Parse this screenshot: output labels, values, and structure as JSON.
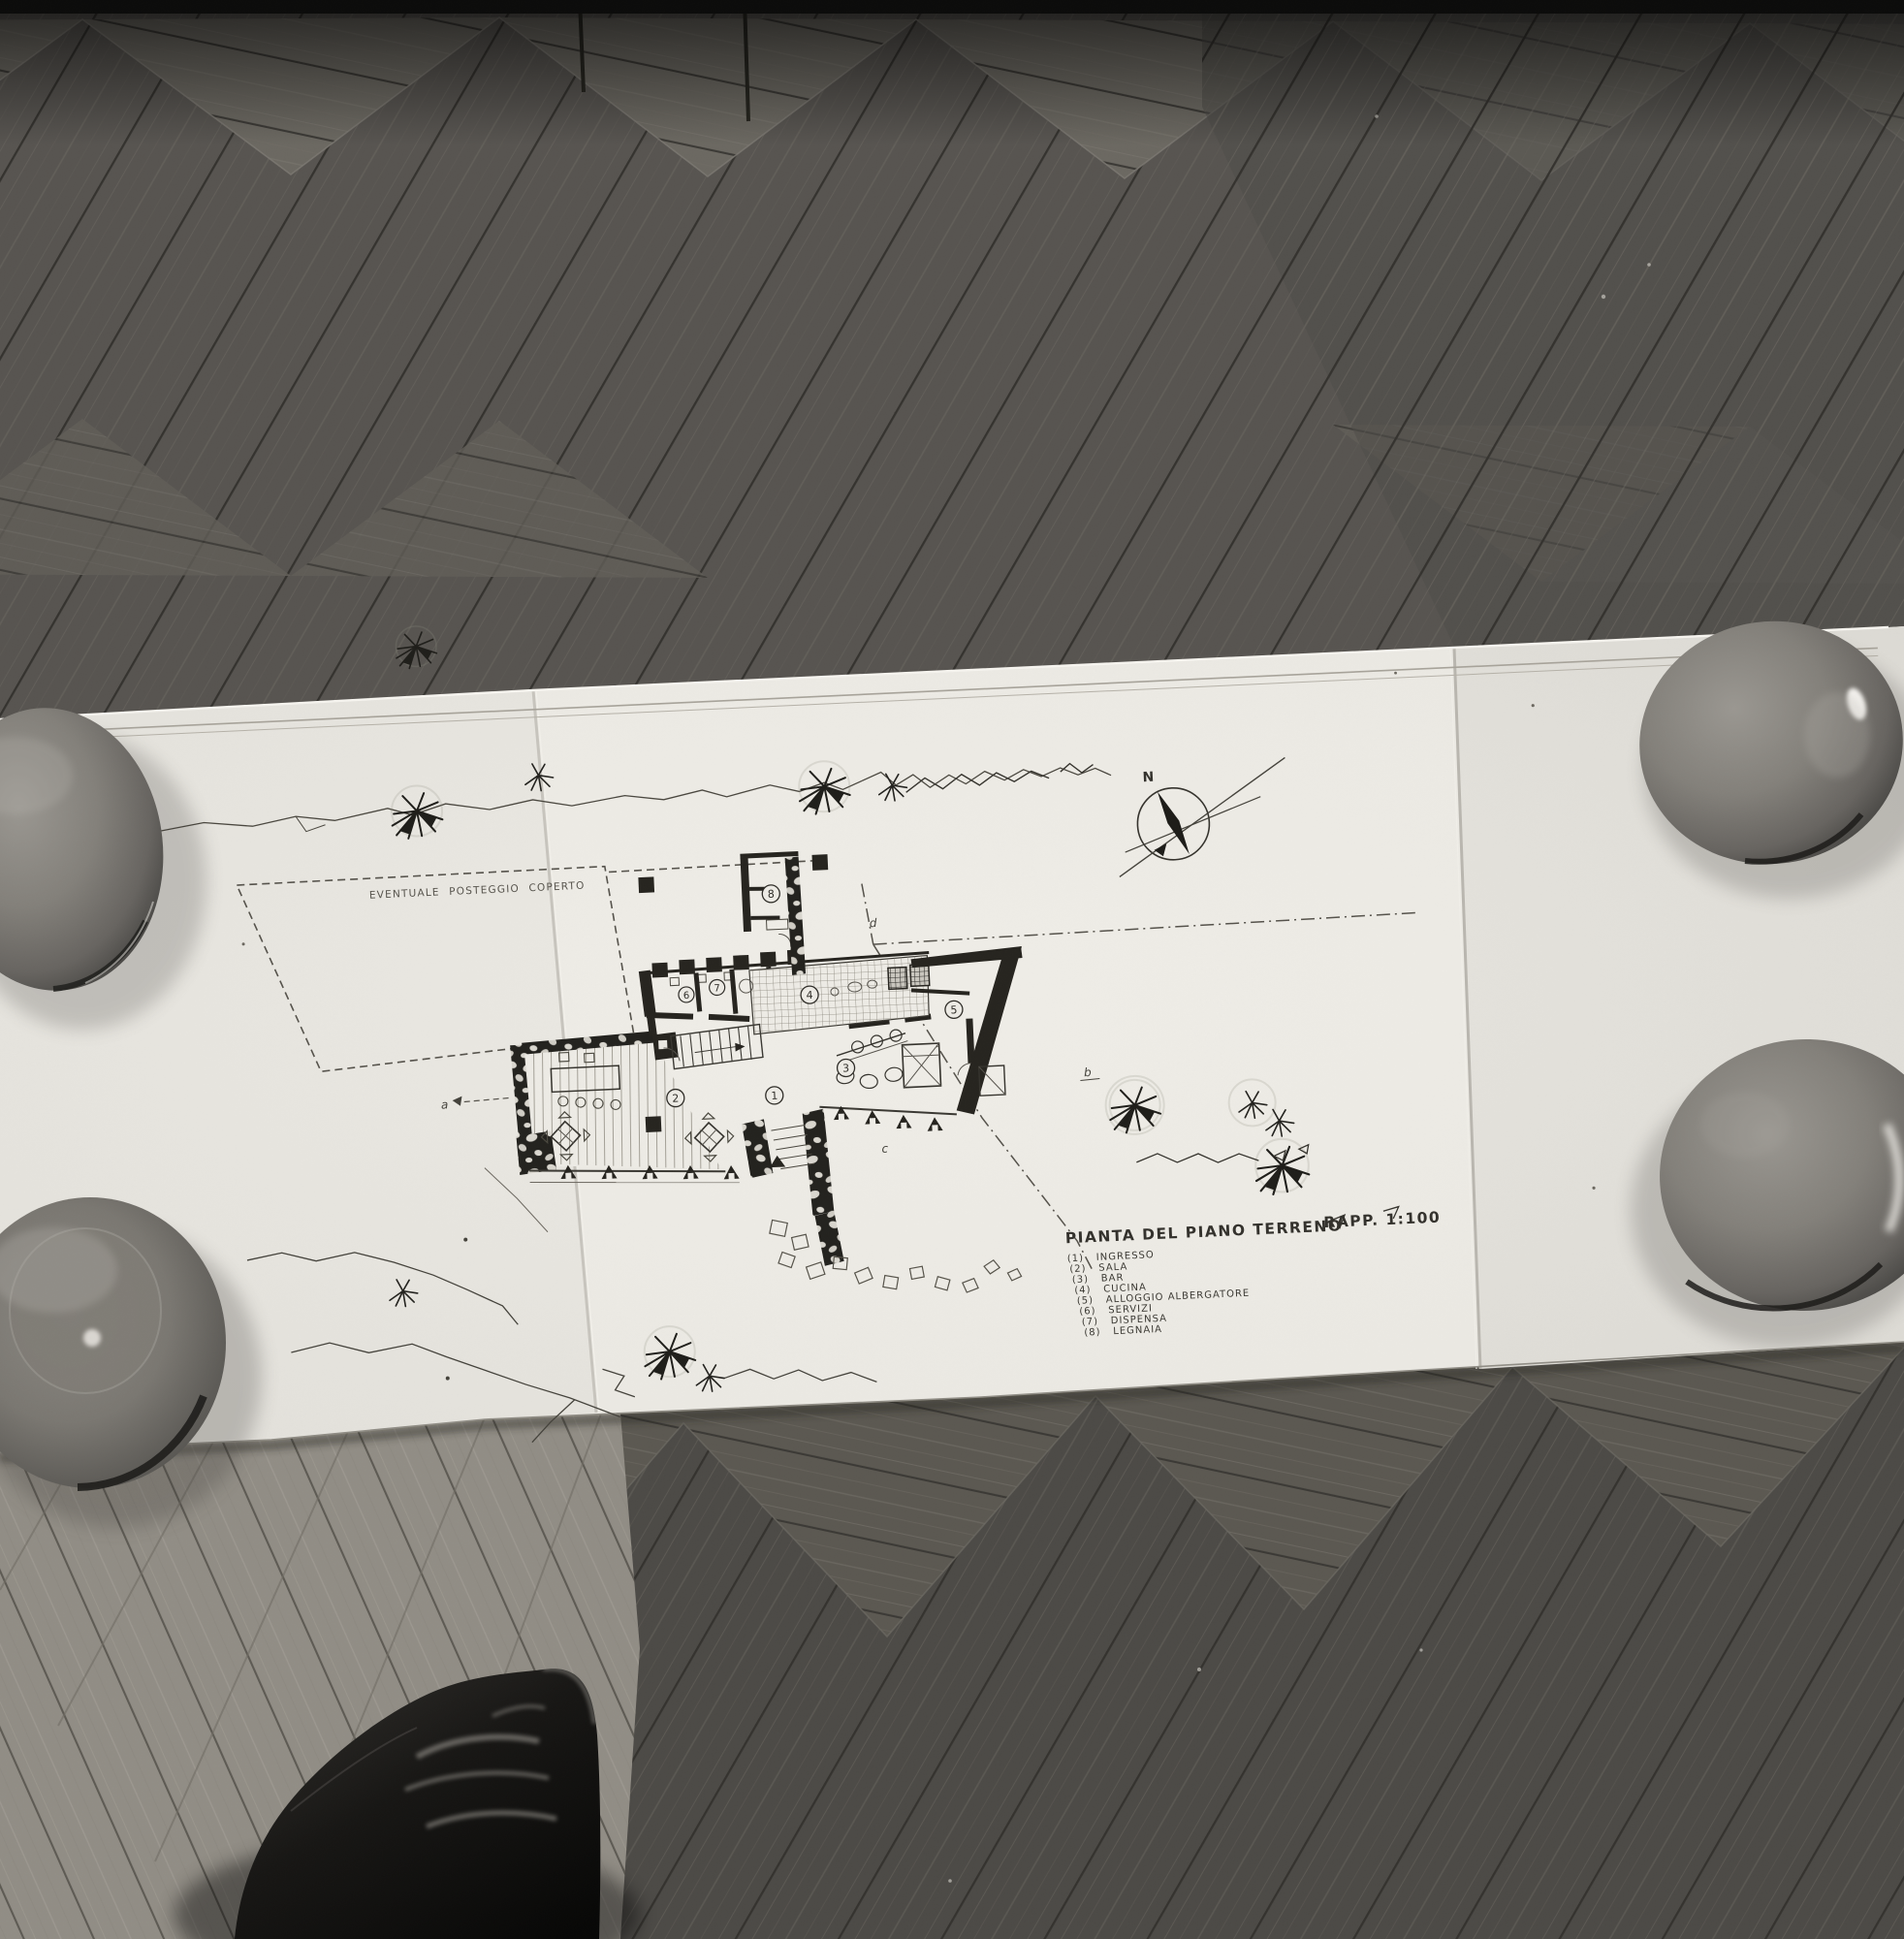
{
  "sheet": {
    "annotation_carport": "EVENTUALE POSTEGGIO COPERTO",
    "compass_north_label": "N",
    "title": "PIANTA DEL PIANO TERRENO",
    "scale_label": "RAPP. 1:100",
    "legend": {
      "items": [
        {
          "num": "(1)",
          "label": "INGRESSO"
        },
        {
          "num": "(2)",
          "label": "SALA"
        },
        {
          "num": "(3)",
          "label": "BAR"
        },
        {
          "num": "(4)",
          "label": "CUCINA"
        },
        {
          "num": "(5)",
          "label": "ALLOGGIO ALBERGATORE"
        },
        {
          "num": "(6)",
          "label": "SERVIZI"
        },
        {
          "num": "(7)",
          "label": "DISPENSA"
        },
        {
          "num": "(8)",
          "label": "LEGNAIA"
        }
      ]
    },
    "room_numbers": [
      "1",
      "2",
      "3",
      "4",
      "5",
      "6",
      "7",
      "8"
    ],
    "section_letters": [
      "a",
      "b",
      "c",
      "d"
    ]
  },
  "colors": {
    "paper": "#e9e7e1",
    "paper_left_panel": "#e2e0da",
    "paper_right_panel": "#dcdad4",
    "floor_dark": "#565350",
    "floor_light": "#908c84",
    "ink": "#26241f",
    "shoe": "#0d0c0b",
    "bowl": "#84817b"
  }
}
